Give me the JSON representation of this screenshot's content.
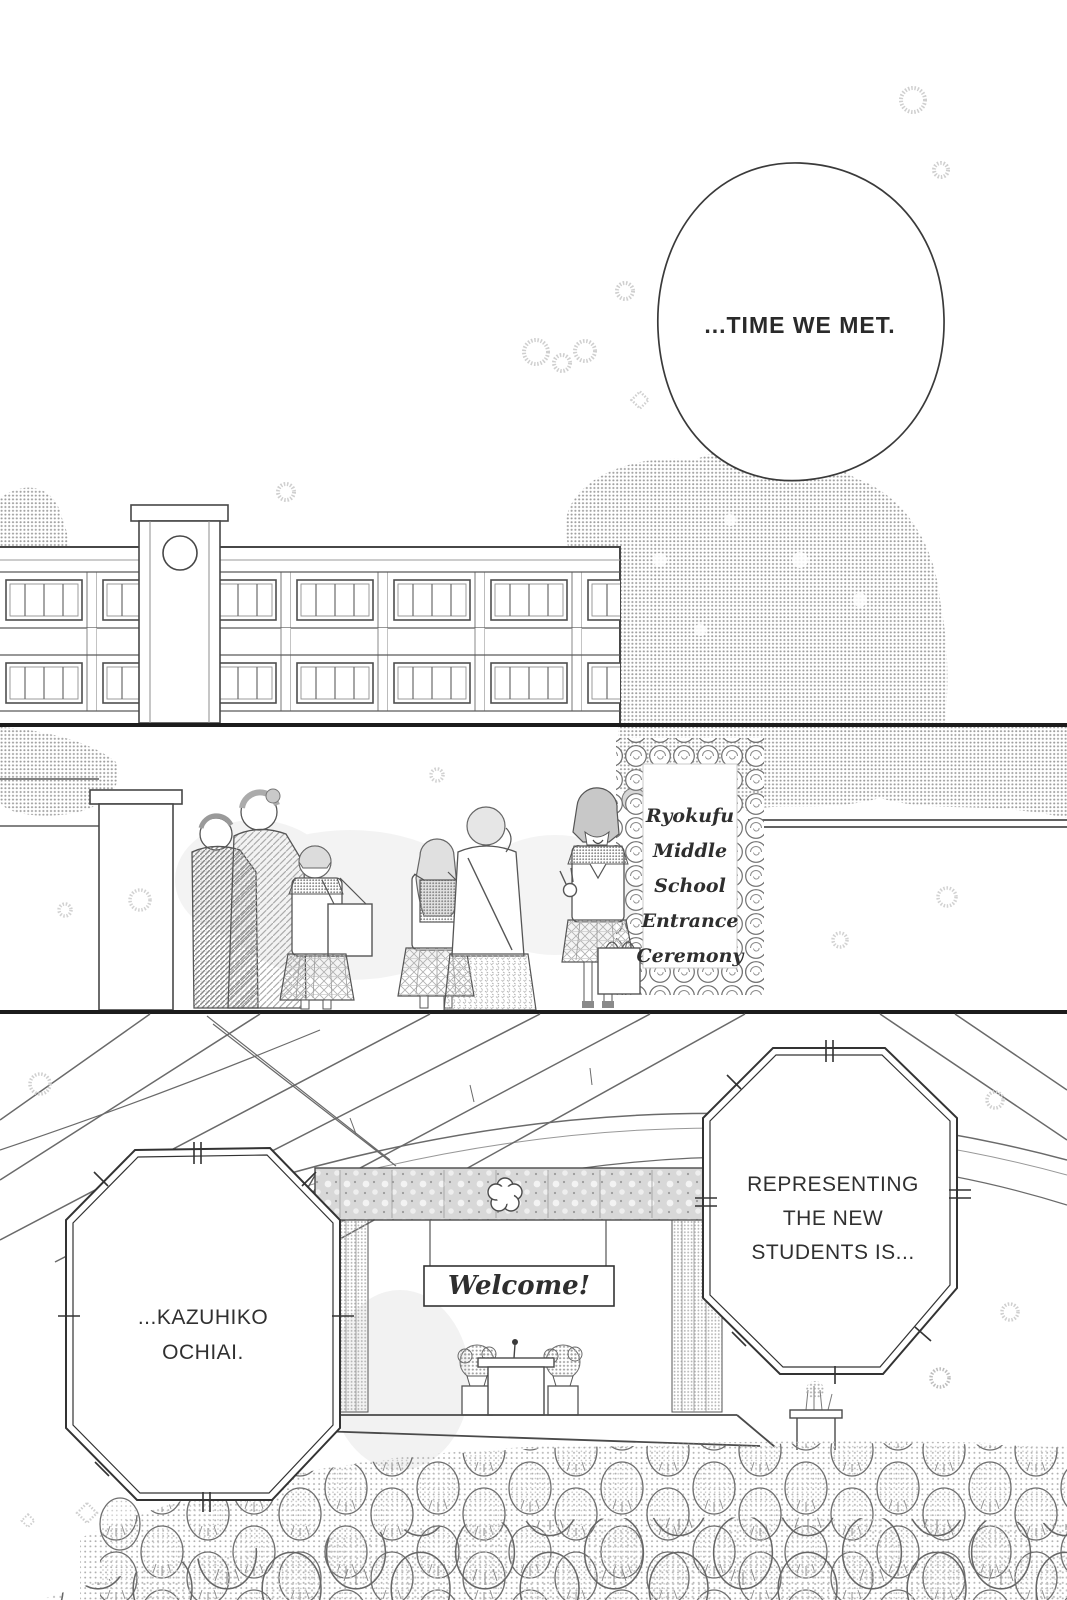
{
  "dialogue": {
    "time_bubble": {
      "text": "...TIME WE MET."
    },
    "representing_bubble": {
      "lines": [
        "REPRESENTING",
        "THE NEW",
        "STUDENTS IS..."
      ]
    },
    "kazuhiko_bubble": {
      "lines": [
        "...KAZUHIKO",
        "OCHIAI."
      ]
    }
  },
  "signs": {
    "entrance_sign": {
      "lines": [
        "Ryokufu",
        "Middle",
        "School",
        "Entrance",
        "Ceremony"
      ]
    },
    "welcome_banner": {
      "text": "Welcome!"
    }
  },
  "colors": {
    "ink": "#2d2d2d",
    "paper": "#ffffff",
    "tone_light": "#c9c9c9",
    "tone_mid": "#9f9f9f"
  }
}
